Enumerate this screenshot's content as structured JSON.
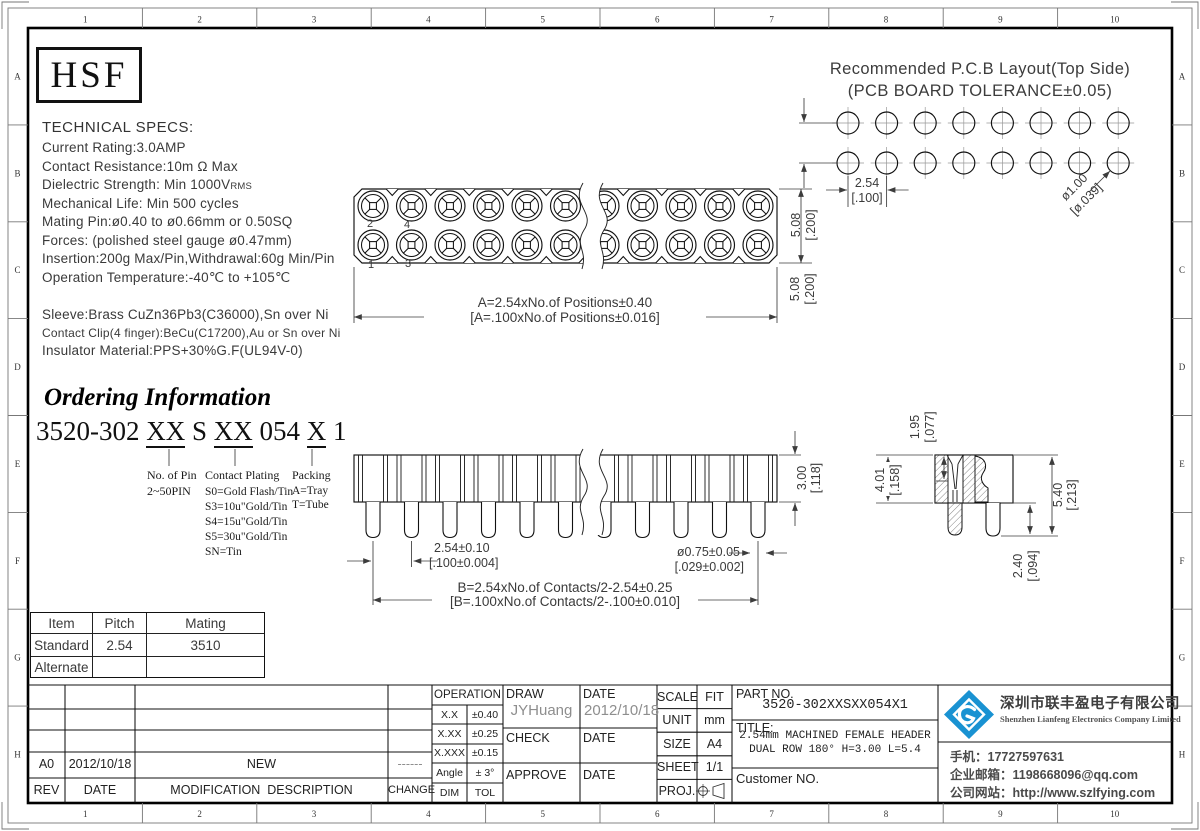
{
  "frame": {
    "cols": [
      "1",
      "2",
      "3",
      "4",
      "5",
      "6",
      "7",
      "8",
      "9",
      "10"
    ],
    "rows": [
      "A",
      "B",
      "C",
      "D",
      "E",
      "F",
      "G",
      "H"
    ]
  },
  "logo": {
    "text": "HSF"
  },
  "pcb": {
    "title1": "Recommended P.C.B Layout(Top Side)",
    "title2": "(PCB BOARD TOLERANCE±0.05)",
    "pitch": "2.54",
    "pitch_in": "[.100]",
    "row": "5.08",
    "row_in": "[.200]",
    "hole": "ø1.00",
    "hole_in": "[ø.039]"
  },
  "specs": {
    "title": "TECHNICAL SPECS:",
    "current": "Current Rating:3.0AMP",
    "resistance": "Contact Resistance:10m Ω Max",
    "dielectric": "Dielectric Strength: Min 1000V",
    "dielectric_sub": "RMS",
    "life": "Mechanical Life: Min 500 cycles",
    "mating": "Mating Pin:ø0.40 to ø0.66mm or 0.50SQ",
    "forces": "Forces: (polished steel gauge ø0.47mm)",
    "insertion": "Insertion:200g Max/Pin,Withdrawal:60g Min/Pin",
    "temperature": "Operation Temperature:-40℃ to +105℃",
    "sleeve": "Sleeve:Brass CuZn36Pb3(C36000),Sn over Ni",
    "clip": "Contact Clip(4 finger):BeCu(C17200),Au or Sn over Ni",
    "insulator": "Insulator Material:PPS+30%G.F(UL94V-0)"
  },
  "ordering": {
    "heading": "Ordering Information",
    "pn1": "3520-302 ",
    "pn2": "XX",
    "pn3": " S ",
    "pn4": "XX",
    "pn5": " 054 ",
    "pn6": "X",
    "pn7": " 1",
    "pin_label": "No. of Pin",
    "pin_range": "2~50PIN",
    "plating_label": "Contact Plating",
    "plating": [
      "S0=Gold Flash/Tin",
      "S3=10u\"Gold/Tin",
      "S4=15u\"Gold/Tin",
      "S5=30u\"Gold/Tin",
      "SN=Tin"
    ],
    "packing_label": "Packing",
    "packing": [
      "A=Tray",
      "T=Tube"
    ]
  },
  "top_view": {
    "dim_a": "A=2.54xNo.of Positions±0.40",
    "dim_a_in": "[A=.100xNo.of Positions±0.016]",
    "height": "5.08",
    "height_in": "[.200]",
    "pins": [
      "2",
      "4",
      "1",
      "3"
    ]
  },
  "side_view": {
    "height": "3.00",
    "height_in": "[.118]",
    "pitch": "2.54±0.10",
    "pitch_in": "[.100±0.004]",
    "dia": "ø0.75±0.05",
    "dia_in": "[.029±0.002]",
    "dim_b": "B=2.54xNo.of Contacts/2-2.54±0.25",
    "dim_b_in": "[B=.100xNo.of Contacts/2-.100±0.010]"
  },
  "detail": {
    "depth": "1.95",
    "depth_in": "[.077]",
    "body": "4.01",
    "body_in": "[.158]",
    "total": "5.40",
    "total_in": "[.213]",
    "tail": "2.40",
    "tail_in": "[.094]"
  },
  "mating_table": {
    "headers": [
      "Item",
      "Pitch",
      "Mating"
    ],
    "row1": [
      "Standard",
      "2.54",
      "3510"
    ],
    "row2": [
      "Alternate",
      "",
      ""
    ]
  },
  "title_block": {
    "operation": {
      "header": "OPERATION",
      "r1l": "X.X",
      "r1v": "±0.40",
      "r2l": "X.XX",
      "r2v": "±0.25",
      "r3l": "X.XXX",
      "r3v": "±0.15",
      "r4l": "Angle",
      "r4v": "± 3°",
      "r5l": "DIM",
      "r5v": "TOL"
    },
    "draw": {
      "label": "DRAW",
      "name": "JYHuang",
      "date_label": "DATE",
      "date": "2012/10/18",
      "check": "CHECK",
      "check_date": "DATE",
      "approve": "APPROVE",
      "approve_date": "DATE"
    },
    "info": {
      "scale_l": "SCALE",
      "scale": "FIT",
      "unit_l": "UNIT",
      "unit": "mm",
      "size_l": "SIZE",
      "size": "A4",
      "sheet_l": "SHEET",
      "sheet": "1/1",
      "proj_l": "PROJ."
    },
    "part": {
      "label": "PART NO.",
      "value": "3520-302XXSXX054X1",
      "title_label": "TITLE:",
      "title1": "2.54mm MACHINED FEMALE HEADER",
      "title2": "DUAL ROW 180° H=3.00 L=5.4",
      "customer": "Customer NO."
    },
    "revision": {
      "rev": "A0",
      "date": "2012/10/18",
      "desc": "NEW",
      "change": "------",
      "rev_l": "REV",
      "date_l": "DATE",
      "desc_l": "MODIFICATION  DESCRIPTION",
      "change_l": "CHANGE"
    }
  },
  "company": {
    "name_cn": "深圳市联丰盈电子有限公司",
    "name_en": "Shenzhen Lianfeng Electronics Company Limited",
    "phone": "手机：17727597631",
    "email": "企业邮箱：1198668096@qq.com",
    "website": "公司网站：http://www.szlfying.com"
  }
}
